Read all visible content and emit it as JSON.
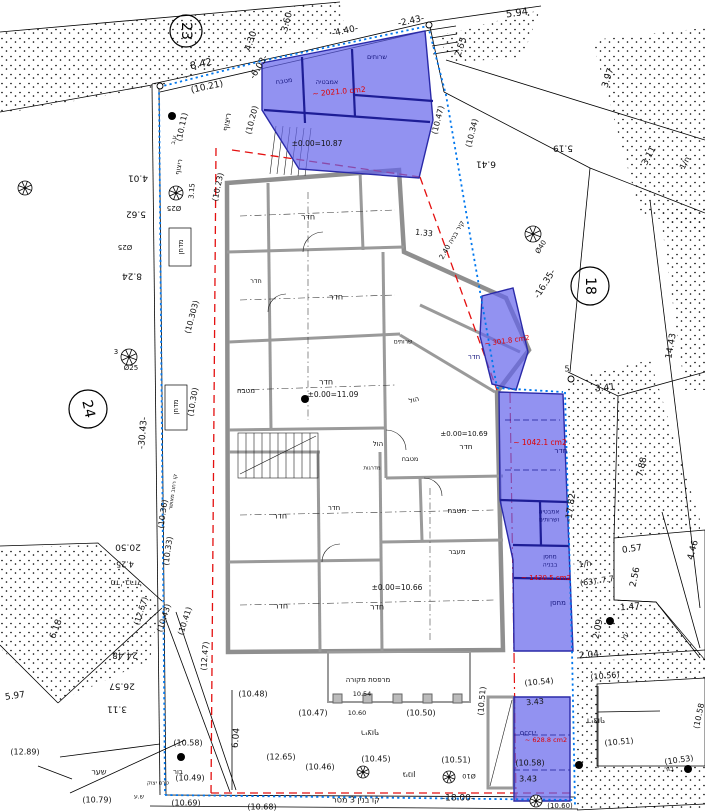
{
  "colors": {
    "highlight_fill": "#6464eb",
    "highlight_wall": "#1d1d96",
    "boundary_blue": "#0077ee",
    "demolition_red": "#e41010",
    "wall_gray": "#8f8f8f",
    "area_text_red": "#e00000",
    "room_text_navy": "#15157d",
    "text_black": "#101010"
  },
  "plot_circles": [
    {
      "n": "23",
      "x": 186,
      "y": 31,
      "r": 16,
      "rot": 90
    },
    {
      "n": "18",
      "x": 590,
      "y": 286,
      "r": 19,
      "rot": 90
    },
    {
      "n": "24",
      "x": 88,
      "y": 409,
      "r": 19,
      "rot": 78
    }
  ],
  "labels": [
    {
      "t": "3.60",
      "x": 287,
      "y": 22,
      "r": -75,
      "s": 9
    },
    {
      "t": "-4.40-",
      "x": 345,
      "y": 31,
      "r": -12,
      "s": 9
    },
    {
      "t": "-2.43-",
      "x": 411,
      "y": 21,
      "r": -12,
      "s": 9
    },
    {
      "t": "5.94",
      "x": 517,
      "y": 13,
      "r": -8,
      "s": 10
    },
    {
      "t": "2.55",
      "x": 461,
      "y": 47,
      "r": -72,
      "s": 9
    },
    {
      "t": "4.30",
      "x": 251,
      "y": 41,
      "r": -72,
      "s": 9
    },
    {
      "t": "-6.03-",
      "x": 259,
      "y": 67,
      "r": -58,
      "s": 9
    },
    {
      "t": "8.42",
      "x": 201,
      "y": 64,
      "r": -12,
      "s": 10
    },
    {
      "t": "(10.21)",
      "x": 207,
      "y": 87,
      "r": -12,
      "s": 9
    },
    {
      "t": "(10.20)",
      "x": 252,
      "y": 120,
      "r": -76,
      "s": 8
    },
    {
      "t": "(10.23)",
      "x": 218,
      "y": 187,
      "r": -78,
      "s": 8
    },
    {
      "t": "ריצוף",
      "x": 227,
      "y": 122,
      "r": -80,
      "s": 8
    },
    {
      "t": "(10.11)",
      "x": 182,
      "y": 127,
      "r": -78,
      "s": 8
    },
    {
      "t": "ע.ב",
      "x": 174,
      "y": 140,
      "r": -78,
      "s": 6
    },
    {
      "t": "ריצוף",
      "x": 179,
      "y": 167,
      "r": -80,
      "s": 7
    },
    {
      "t": "3.97",
      "x": 608,
      "y": 78,
      "r": -72,
      "s": 9
    },
    {
      "t": "5.19",
      "x": 563,
      "y": 148,
      "r": 180,
      "s": 9
    },
    {
      "t": "6.41",
      "x": 486,
      "y": 164,
      "r": 180,
      "s": 9
    },
    {
      "t": "(10.34)",
      "x": 472,
      "y": 133,
      "r": -76,
      "s": 8
    },
    {
      "t": "(10.47)",
      "x": 438,
      "y": 120,
      "r": -76,
      "s": 8
    },
    {
      "t": "3.11",
      "x": 649,
      "y": 156,
      "r": -62,
      "s": 9
    },
    {
      "t": "ח/1",
      "x": 685,
      "y": 163,
      "r": -62,
      "s": 8
    },
    {
      "t": "שרותים",
      "x": 377,
      "y": 57,
      "r": 0,
      "s": 6.5,
      "c": "n"
    },
    {
      "t": "אמבטיה",
      "x": 327,
      "y": 82,
      "r": 0,
      "s": 6.5,
      "c": "n"
    },
    {
      "t": "מטבח",
      "x": 284,
      "y": 81,
      "r": -8,
      "s": 6.5,
      "c": "n"
    },
    {
      "t": "~ 2021.0 cm2",
      "x": 339,
      "y": 92,
      "r": -5,
      "s": 7.5,
      "c": "r"
    },
    {
      "t": "±0.00=10.87",
      "x": 317,
      "y": 144,
      "r": 0,
      "s": 7.5
    },
    {
      "t": "14.43",
      "x": 671,
      "y": 346,
      "r": -80,
      "s": 9
    },
    {
      "t": "Ø40",
      "x": 541,
      "y": 247,
      "r": -58,
      "s": 7
    },
    {
      "t": "-16.35-",
      "x": 545,
      "y": 284,
      "r": -58,
      "s": 9
    },
    {
      "t": "קיר בניה 2.40",
      "x": 452,
      "y": 240,
      "r": -60,
      "s": 7
    },
    {
      "t": "1.33",
      "x": 424,
      "y": 233,
      "r": 6,
      "s": 8
    },
    {
      "t": "5",
      "x": 567,
      "y": 369,
      "r": 0,
      "s": 8
    },
    {
      "t": "3.41",
      "x": 605,
      "y": 388,
      "r": -6,
      "s": 9
    },
    {
      "t": "7.88",
      "x": 642,
      "y": 467,
      "r": -78,
      "s": 9
    },
    {
      "t": "-17.82-",
      "x": 571,
      "y": 506,
      "r": -82,
      "s": 9
    },
    {
      "t": "0.57",
      "x": 632,
      "y": 549,
      "r": -8,
      "s": 9
    },
    {
      "t": "2.56",
      "x": 635,
      "y": 577,
      "r": -78,
      "s": 9
    },
    {
      "t": "4.46",
      "x": 693,
      "y": 550,
      "r": -75,
      "s": 9
    },
    {
      "t": "ח/1",
      "x": 585,
      "y": 564,
      "r": -8,
      "s": 8
    },
    {
      "t": "(63). 7.7",
      "x": 597,
      "y": 581,
      "r": -8,
      "s": 8
    },
    {
      "t": "1.47",
      "x": 630,
      "y": 607,
      "r": -5,
      "s": 9
    },
    {
      "t": "2.09",
      "x": 598,
      "y": 629,
      "r": -78,
      "s": 9
    },
    {
      "t": "עץ",
      "x": 625,
      "y": 636,
      "r": -50,
      "s": 7
    },
    {
      "t": "2.04",
      "x": 589,
      "y": 655,
      "r": -5,
      "s": 9
    },
    {
      "t": "(10.56)",
      "x": 605,
      "y": 676,
      "r": -5,
      "s": 8
    },
    {
      "t": "(10.54)",
      "x": 539,
      "y": 682,
      "r": -5,
      "s": 8
    },
    {
      "t": "(10.51)",
      "x": 482,
      "y": 701,
      "r": -85,
      "s": 8
    },
    {
      "t": "3.43",
      "x": 535,
      "y": 702,
      "r": -5,
      "s": 8
    },
    {
      "t": "ריצוף",
      "x": 596,
      "y": 721,
      "r": 180,
      "s": 8
    },
    {
      "t": "(10.51)",
      "x": 619,
      "y": 742,
      "r": -5,
      "s": 8
    },
    {
      "t": "(10.58",
      "x": 699,
      "y": 716,
      "r": -78,
      "s": 8
    },
    {
      "t": "(10.53)",
      "x": 679,
      "y": 760,
      "r": -8,
      "s": 8
    },
    {
      "t": "בור",
      "x": 669,
      "y": 769,
      "r": -8,
      "s": 7
    },
    {
      "t": "סככה",
      "x": 528,
      "y": 733,
      "r": 180,
      "s": 7,
      "c": "n"
    },
    {
      "t": "~ 628.8 cm2",
      "x": 546,
      "y": 740,
      "r": 0,
      "s": 6.5,
      "c": "r"
    },
    {
      "t": "(10.58)",
      "x": 530,
      "y": 763,
      "r": 0,
      "s": 8
    },
    {
      "t": "3.43",
      "x": 528,
      "y": 779,
      "r": 0,
      "s": 8
    },
    {
      "t": "(10.60)",
      "x": 560,
      "y": 806,
      "r": 0,
      "s": 7
    },
    {
      "t": "-18.00-",
      "x": 458,
      "y": 798,
      "r": 0,
      "s": 9
    },
    {
      "t": "קו בנין 3 מטר",
      "x": 356,
      "y": 800,
      "r": 0,
      "s": 8
    },
    {
      "t": "(10.68)",
      "x": 262,
      "y": 807,
      "r": 0,
      "s": 8
    },
    {
      "t": "(10.69)",
      "x": 186,
      "y": 803,
      "r": 0,
      "s": 8
    },
    {
      "t": "ש.ע",
      "x": 139,
      "y": 797,
      "r": 0,
      "s": 6
    },
    {
      "t": "(10.79)",
      "x": 97,
      "y": 800,
      "r": 0,
      "s": 8
    },
    {
      "t": "שער",
      "x": 99,
      "y": 772,
      "r": 0,
      "s": 8
    },
    {
      "t": "(12.89)",
      "x": 25,
      "y": 752,
      "r": 0,
      "s": 8
    },
    {
      "t": "בור",
      "x": 178,
      "y": 772,
      "r": 0,
      "s": 7
    },
    {
      "t": "טרם יצוק",
      "x": 158,
      "y": 783,
      "r": 0,
      "s": 5.5
    },
    {
      "t": "(10.58)",
      "x": 188,
      "y": 743,
      "r": 0,
      "s": 8
    },
    {
      "t": "(12.65)",
      "x": 281,
      "y": 757,
      "r": 0,
      "s": 8
    },
    {
      "t": "(10.46)",
      "x": 320,
      "y": 767,
      "r": 0,
      "s": 8
    },
    {
      "t": "(10.45)",
      "x": 376,
      "y": 759,
      "r": 0,
      "s": 8
    },
    {
      "t": "(10.51)",
      "x": 456,
      "y": 760,
      "r": 0,
      "s": 8
    },
    {
      "t": "(10.49)",
      "x": 190,
      "y": 778,
      "r": 0,
      "s": 8
    },
    {
      "t": "גינון",
      "x": 409,
      "y": 775,
      "r": 180,
      "s": 8
    },
    {
      "t": "Ø10",
      "x": 469,
      "y": 776,
      "r": 180,
      "s": 6.5
    },
    {
      "t": "6.04",
      "x": 236,
      "y": 738,
      "r": -85,
      "s": 9
    },
    {
      "t": "(10.48)",
      "x": 253,
      "y": 694,
      "r": 0,
      "s": 8
    },
    {
      "t": "(10.47)",
      "x": 313,
      "y": 713,
      "r": 0,
      "s": 8
    },
    {
      "t": "10.54",
      "x": 362,
      "y": 694,
      "r": 0,
      "s": 6.5
    },
    {
      "t": "10.60",
      "x": 357,
      "y": 713,
      "r": 0,
      "s": 6.5
    },
    {
      "t": "(10.50)",
      "x": 421,
      "y": 713,
      "r": 0,
      "s": 8
    },
    {
      "t": "ריצוף",
      "x": 370,
      "y": 733,
      "r": 180,
      "s": 8
    },
    {
      "t": "מרפסת מקורה",
      "x": 368,
      "y": 680,
      "r": 0,
      "s": 7
    },
    {
      "t": "(10.43)",
      "x": 164,
      "y": 618,
      "r": -72,
      "s": 8
    },
    {
      "t": "(12.57)",
      "x": 141,
      "y": 611,
      "r": -72,
      "s": 8
    },
    {
      "t": "(10.41)",
      "x": 185,
      "y": 621,
      "r": -72,
      "s": 8
    },
    {
      "t": "(12.47)",
      "x": 205,
      "y": 656,
      "r": -85,
      "s": 8
    },
    {
      "t": "24.48",
      "x": 125,
      "y": 655,
      "r": 180,
      "s": 9
    },
    {
      "t": "26.57",
      "x": 122,
      "y": 686,
      "r": 180,
      "s": 9
    },
    {
      "t": "3.11",
      "x": 117,
      "y": 709,
      "r": 180,
      "s": 9
    },
    {
      "t": "6.18",
      "x": 56,
      "y": 629,
      "r": -70,
      "s": 9
    },
    {
      "t": "5.97",
      "x": 15,
      "y": 696,
      "r": -8,
      "s": 9
    },
    {
      "t": "מד' ברזל",
      "x": 126,
      "y": 583,
      "r": 180,
      "s": 8
    },
    {
      "t": "4.25",
      "x": 125,
      "y": 564,
      "r": 180,
      "s": 8
    },
    {
      "t": "20.50",
      "x": 128,
      "y": 547,
      "r": 180,
      "s": 9
    },
    {
      "t": "(10.33)",
      "x": 168,
      "y": 551,
      "r": -82,
      "s": 8
    },
    {
      "t": "(10.36)",
      "x": 163,
      "y": 514,
      "r": -82,
      "s": 8
    },
    {
      "t": "קו רחוב מאושר",
      "x": 173,
      "y": 492,
      "r": -82,
      "s": 5.5
    },
    {
      "t": "(10.30)",
      "x": 193,
      "y": 402,
      "r": -80,
      "s": 8
    },
    {
      "t": "-30.43-",
      "x": 143,
      "y": 433,
      "r": -85,
      "s": 9
    },
    {
      "t": "מדחן",
      "x": 176,
      "y": 407,
      "r": -90,
      "s": 7
    },
    {
      "t": "מדחן",
      "x": 181,
      "y": 247,
      "r": -90,
      "s": 7
    },
    {
      "t": "(10.303)",
      "x": 192,
      "y": 317,
      "r": -75,
      "s": 8
    },
    {
      "t": "4.01",
      "x": 138,
      "y": 178,
      "r": 180,
      "s": 9
    },
    {
      "t": "5.62",
      "x": 136,
      "y": 214,
      "r": 180,
      "s": 9
    },
    {
      "t": "Ø25",
      "x": 174,
      "y": 208,
      "r": 180,
      "s": 7
    },
    {
      "t": "3.15",
      "x": 192,
      "y": 191,
      "r": -85,
      "s": 7
    },
    {
      "t": "Ø25",
      "x": 125,
      "y": 247,
      "r": 180,
      "s": 7
    },
    {
      "t": "8.24",
      "x": 132,
      "y": 276,
      "r": 180,
      "s": 9
    },
    {
      "t": "3",
      "x": 116,
      "y": 352,
      "r": 0,
      "s": 7
    },
    {
      "t": "Ø25",
      "x": 131,
      "y": 368,
      "r": 0,
      "s": 7
    },
    {
      "t": "חדר",
      "x": 308,
      "y": 217,
      "r": 0,
      "s": 8
    },
    {
      "t": "חדר",
      "x": 336,
      "y": 297,
      "r": 0,
      "s": 8
    },
    {
      "t": "חדר",
      "x": 256,
      "y": 281,
      "r": 0,
      "s": 6.5
    },
    {
      "t": "חדר",
      "x": 326,
      "y": 382,
      "r": 0,
      "s": 8
    },
    {
      "t": "±0.00=11.09",
      "x": 333,
      "y": 395,
      "r": 0,
      "s": 7.5
    },
    {
      "t": "מטבח",
      "x": 246,
      "y": 391,
      "r": 0,
      "s": 7
    },
    {
      "t": "שרותים",
      "x": 403,
      "y": 342,
      "r": 0,
      "s": 6
    },
    {
      "t": "חדר",
      "x": 474,
      "y": 357,
      "r": 0,
      "s": 7,
      "c": "n"
    },
    {
      "t": "הול",
      "x": 414,
      "y": 400,
      "r": -15,
      "s": 7
    },
    {
      "t": "הול",
      "x": 378,
      "y": 444,
      "r": 0,
      "s": 7
    },
    {
      "t": "חדר",
      "x": 466,
      "y": 447,
      "r": 0,
      "s": 7.5
    },
    {
      "t": "±0.00=10.69",
      "x": 464,
      "y": 434,
      "r": 0,
      "s": 7
    },
    {
      "t": "מדרגות",
      "x": 372,
      "y": 468,
      "r": 0,
      "s": 5.5
    },
    {
      "t": "מטבח",
      "x": 410,
      "y": 459,
      "r": 0,
      "s": 6.5
    },
    {
      "t": "~ 301.8 cm2",
      "x": 507,
      "y": 341,
      "r": -8,
      "s": 7,
      "c": "r"
    },
    {
      "t": "חדר",
      "x": 561,
      "y": 451,
      "r": 0,
      "s": 7.5,
      "c": "n"
    },
    {
      "t": "~ 1042.1 cm2",
      "x": 540,
      "y": 443,
      "r": 0,
      "s": 7.5,
      "c": "r"
    },
    {
      "t": "אמבטיה",
      "x": 549,
      "y": 512,
      "r": 0,
      "s": 6,
      "c": "n"
    },
    {
      "t": "ושרותים",
      "x": 549,
      "y": 520,
      "r": 0,
      "s": 6,
      "c": "n"
    },
    {
      "t": "מחסן",
      "x": 550,
      "y": 557,
      "r": 0,
      "s": 6,
      "c": "n"
    },
    {
      "t": "בבניה",
      "x": 550,
      "y": 565,
      "r": 0,
      "s": 6,
      "c": "n"
    },
    {
      "t": "~ 1430.5 cm2",
      "x": 546,
      "y": 578,
      "r": 0,
      "s": 7,
      "c": "r"
    },
    {
      "t": "מחסן",
      "x": 558,
      "y": 603,
      "r": 0,
      "s": 7,
      "c": "n"
    },
    {
      "t": "חדר",
      "x": 280,
      "y": 516,
      "r": 0,
      "s": 8
    },
    {
      "t": "חדר",
      "x": 334,
      "y": 508,
      "r": 0,
      "s": 7
    },
    {
      "t": "מטבח",
      "x": 457,
      "y": 511,
      "r": 0,
      "s": 7.5
    },
    {
      "t": "מעבר",
      "x": 457,
      "y": 552,
      "r": 0,
      "s": 7
    },
    {
      "t": "±0.00=10.66",
      "x": 397,
      "y": 588,
      "r": 0,
      "s": 7.5
    },
    {
      "t": "חדר",
      "x": 377,
      "y": 607,
      "r": 0,
      "s": 8
    },
    {
      "t": "חדר",
      "x": 281,
      "y": 606,
      "r": 0,
      "s": 8
    }
  ],
  "trees": [
    {
      "x": 25,
      "y": 188,
      "r": 7
    },
    {
      "x": 176,
      "y": 193,
      "r": 7
    },
    {
      "x": 129,
      "y": 357,
      "r": 8
    },
    {
      "x": 533,
      "y": 234,
      "r": 8
    },
    {
      "x": 363,
      "y": 772,
      "r": 6
    },
    {
      "x": 449,
      "y": 777,
      "r": 6
    },
    {
      "x": 536,
      "y": 801,
      "r": 6
    }
  ],
  "survey_dots": [
    {
      "x": 172,
      "y": 116
    },
    {
      "x": 305,
      "y": 399
    },
    {
      "x": 610,
      "y": 621
    },
    {
      "x": 688,
      "y": 769
    },
    {
      "x": 181,
      "y": 757
    },
    {
      "x": 579,
      "y": 765
    }
  ],
  "boundary_points": [
    {
      "x": 160,
      "y": 86
    },
    {
      "x": 429,
      "y": 25
    },
    {
      "x": 571,
      "y": 379
    }
  ]
}
